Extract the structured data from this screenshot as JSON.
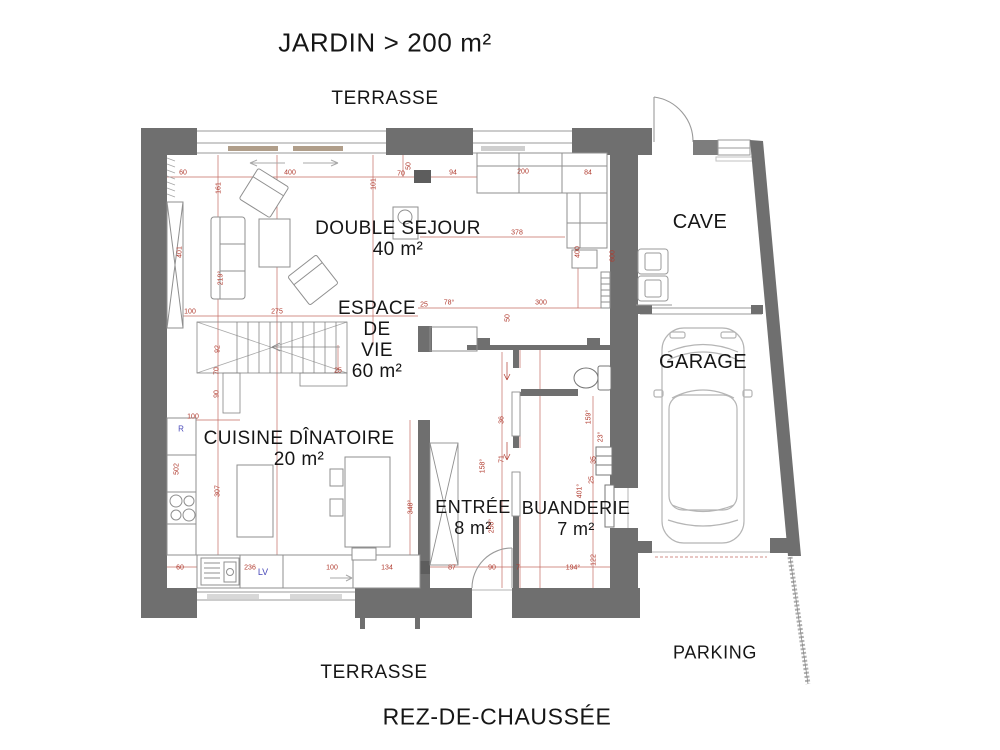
{
  "site": {
    "jardin": "JARDIN > 200 m²",
    "terrasse_top": "TERRASSE",
    "terrasse_bottom": "TERRASSE",
    "parking": "PARKING",
    "floor_title": "REZ-DE-CHAUSSÉE"
  },
  "rooms": [
    {
      "id": "double-sejour",
      "lines": [
        "DOUBLE SEJOUR",
        "40 m²"
      ],
      "x": 398,
      "y": 239,
      "fs": 19,
      "lh": 21
    },
    {
      "id": "espace-de-vie",
      "lines": [
        "ESPACE",
        "DE",
        "VIE",
        "60 m²"
      ],
      "x": 377,
      "y": 340,
      "fs": 19,
      "lh": 21
    },
    {
      "id": "cuisine-dinatoire",
      "lines": [
        "CUISINE DÎNATOIRE",
        "20 m²"
      ],
      "x": 299,
      "y": 449,
      "fs": 19,
      "lh": 21
    },
    {
      "id": "entree",
      "lines": [
        "ENTRÉE",
        "8 m²"
      ],
      "x": 473,
      "y": 518,
      "fs": 18,
      "lh": 21
    },
    {
      "id": "buanderie",
      "lines": [
        "BUANDERIE",
        "7 m²"
      ],
      "x": 576,
      "y": 519,
      "fs": 18,
      "lh": 21
    },
    {
      "id": "cave",
      "lines": [
        "CAVE"
      ],
      "x": 700,
      "y": 222,
      "fs": 20,
      "lh": 22
    },
    {
      "id": "garage",
      "lines": [
        "GARAGE"
      ],
      "x": 703,
      "y": 362,
      "fs": 20,
      "lh": 22
    }
  ],
  "blue_notes": [
    {
      "t": "LV",
      "x": 263,
      "y": 572,
      "fs": 9
    },
    {
      "t": "R",
      "x": 181,
      "y": 429,
      "fs": 8
    }
  ],
  "dimensions": [
    {
      "t": "60",
      "x": 183,
      "y": 173
    },
    {
      "t": "400",
      "x": 290,
      "y": 173
    },
    {
      "t": "101",
      "x": 374,
      "y": 184,
      "r": 1
    },
    {
      "t": "50",
      "x": 409,
      "y": 166,
      "r": 1
    },
    {
      "t": "70",
      "x": 401,
      "y": 174
    },
    {
      "t": "94",
      "x": 453,
      "y": 173
    },
    {
      "t": "200",
      "x": 523,
      "y": 172
    },
    {
      "t": "84",
      "x": 588,
      "y": 173
    },
    {
      "t": "161",
      "x": 219,
      "y": 188,
      "r": 1
    },
    {
      "t": "401",
      "x": 180,
      "y": 252,
      "r": 1
    },
    {
      "t": "219°",
      "x": 221,
      "y": 278,
      "r": 1
    },
    {
      "t": "100",
      "x": 190,
      "y": 312
    },
    {
      "t": "275",
      "x": 277,
      "y": 312
    },
    {
      "t": "92",
      "x": 218,
      "y": 349,
      "r": 1
    },
    {
      "t": "70",
      "x": 217,
      "y": 371,
      "r": 1
    },
    {
      "t": "25",
      "x": 338,
      "y": 371
    },
    {
      "t": "90",
      "x": 217,
      "y": 394,
      "r": 1
    },
    {
      "t": "100",
      "x": 193,
      "y": 417
    },
    {
      "t": "502",
      "x": 177,
      "y": 469,
      "r": 1
    },
    {
      "t": "307",
      "x": 218,
      "y": 491,
      "r": 1
    },
    {
      "t": "378",
      "x": 517,
      "y": 233
    },
    {
      "t": "400",
      "x": 578,
      "y": 252,
      "r": 1
    },
    {
      "t": "600",
      "x": 613,
      "y": 256,
      "r": 1
    },
    {
      "t": "25",
      "x": 424,
      "y": 305
    },
    {
      "t": "78°",
      "x": 449,
      "y": 303
    },
    {
      "t": "300",
      "x": 541,
      "y": 303
    },
    {
      "t": "50",
      "x": 508,
      "y": 318,
      "r": 1
    },
    {
      "t": "36",
      "x": 502,
      "y": 420,
      "r": 1
    },
    {
      "t": "71",
      "x": 502,
      "y": 459,
      "r": 1
    },
    {
      "t": "158°",
      "x": 483,
      "y": 466,
      "r": 1
    },
    {
      "t": "250°",
      "x": 492,
      "y": 526,
      "r": 1
    },
    {
      "t": "348°",
      "x": 411,
      "y": 507,
      "r": 1
    },
    {
      "t": "159°",
      "x": 589,
      "y": 417,
      "r": 1
    },
    {
      "t": "23°",
      "x": 601,
      "y": 437,
      "r": 1
    },
    {
      "t": "35",
      "x": 594,
      "y": 460,
      "r": 1
    },
    {
      "t": "25",
      "x": 592,
      "y": 480,
      "r": 1
    },
    {
      "t": "401°",
      "x": 580,
      "y": 491,
      "r": 1
    },
    {
      "t": "122",
      "x": 594,
      "y": 560,
      "r": 1
    },
    {
      "t": "60",
      "x": 180,
      "y": 568
    },
    {
      "t": "236",
      "x": 250,
      "y": 568
    },
    {
      "t": "100",
      "x": 332,
      "y": 568
    },
    {
      "t": "134",
      "x": 387,
      "y": 568
    },
    {
      "t": "87",
      "x": 452,
      "y": 568
    },
    {
      "t": "90",
      "x": 492,
      "y": 568
    },
    {
      "t": "7",
      "x": 518,
      "y": 568
    },
    {
      "t": "194°",
      "x": 573,
      "y": 568
    }
  ],
  "colors": {
    "wall": "#6f6f6f",
    "wall_block": "#5d5d5d",
    "dim_red": "#b03a2e",
    "blue": "#4747b8",
    "furniture": "#8f8f8f",
    "fixture": "#777777",
    "panel": "#b09e8a"
  }
}
